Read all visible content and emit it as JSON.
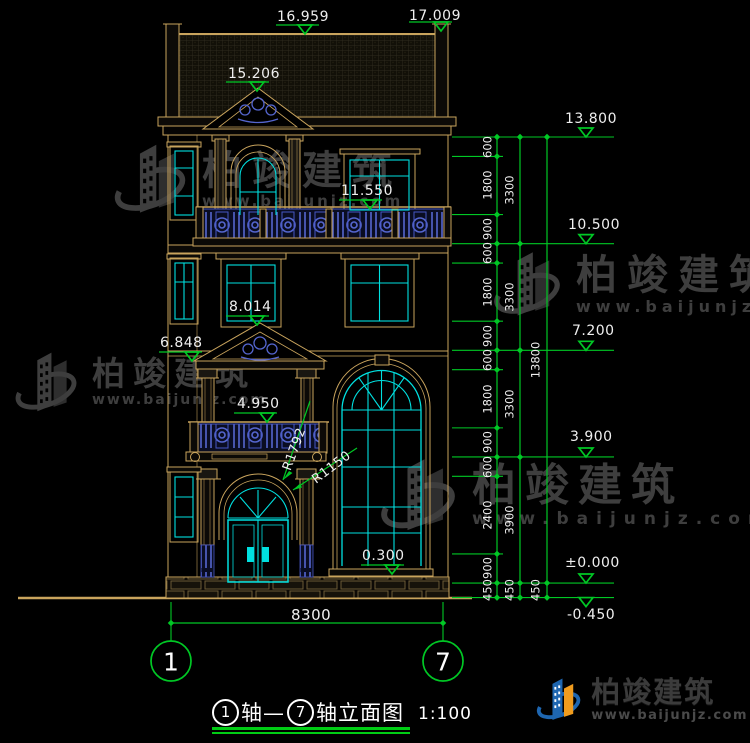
{
  "colors": {
    "dim_green": "#00C825",
    "cad_tan": "#C9A45D",
    "glass_cyan": "#00E0E0",
    "ornament_blue": "#5566CF",
    "text_white": "#EFEFEF",
    "logo_blue": "#1E66B0",
    "logo_orange": "#F09C1E",
    "watermark_gray": "#3E3E3E"
  },
  "elevation_marks_left": {
    "ridge_left": "16.959",
    "ridge_right": "17.009",
    "pediment_top": "15.206",
    "balcony_f3": "11.550",
    "window_f2": "8.014",
    "left_f2": "6.848",
    "balcony_f1": "4.950",
    "entrance": "0.300"
  },
  "elevation_marks_right": {
    "v13800": "13.800",
    "v10500": "10.500",
    "v7200": "7.200",
    "v3900": "3.900",
    "v0": "±0.000",
    "vneg450": "-0.450"
  },
  "dimension_chains": {
    "fine": [
      "600",
      "1800",
      "900",
      "600",
      "1800",
      "900",
      "600",
      "1800",
      "900",
      "600",
      "2400",
      "900",
      "450"
    ],
    "floors": [
      "3300",
      "3300",
      "3300",
      "3900",
      "450"
    ],
    "total": [
      "13800",
      "450"
    ]
  },
  "radius_labels": {
    "outer": "R1792",
    "inner": "R1150"
  },
  "bottom_dimension": {
    "width": "8300",
    "axis_left": "1",
    "axis_right": "7"
  },
  "title": {
    "axis_left": "1",
    "axis_right": "7",
    "segment_a": "轴—",
    "segment_b": "轴立面图",
    "scale": "1:100"
  },
  "watermark": {
    "brand": "柏竣建筑",
    "url": "www.baijunjz.com"
  },
  "logo": {
    "brand": "柏竣建筑",
    "url": "www.baijunjz.com"
  }
}
